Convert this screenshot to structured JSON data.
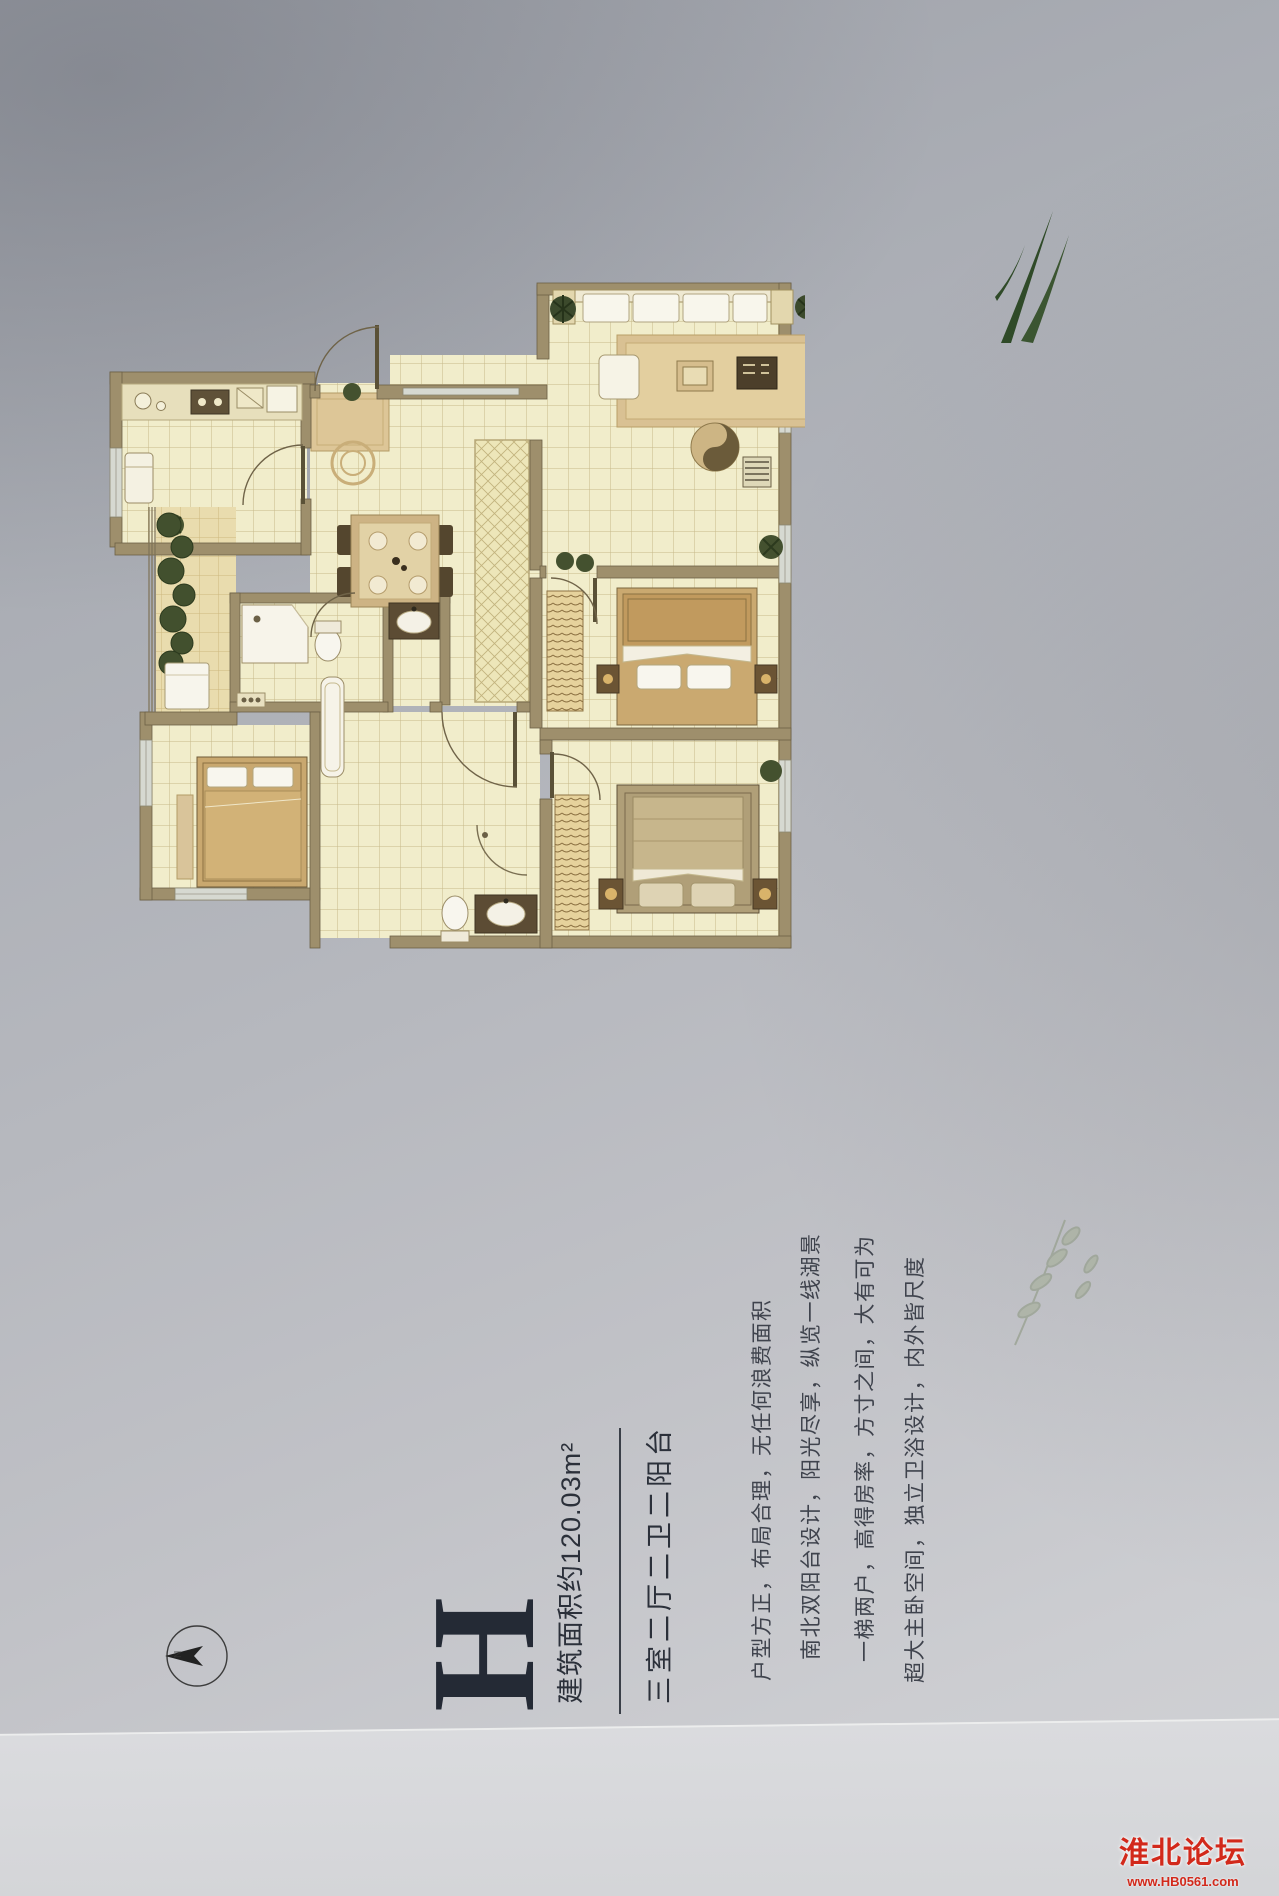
{
  "unit": {
    "letter": "H",
    "area_label": "建筑面积约120.03m²",
    "layout_label": "三室二厅二卫二阳台",
    "features": [
      "户型方正，布局合理，无任何浪费面积",
      "南北双阳台设计，阳光尽享，纵览一线湖景",
      "一梯两户，高得房率，方寸之间，大有可为",
      "超大主卧空间，独立卫浴设计，内外皆尺度"
    ]
  },
  "compass": {
    "north_label": "N"
  },
  "watermark": {
    "site_name": "淮北论坛",
    "site_url": "www.HB0561.com",
    "accent_color": "#d2291b"
  },
  "floorplan": {
    "wall_color": "#9e8f6c",
    "floor_color": "#f1edcb",
    "balcony_floor_color": "#e9dcae",
    "plant_color": "#42502e",
    "rooms": [
      "kitchen",
      "entry",
      "living-room",
      "dining-area",
      "hallway",
      "bathroom",
      "master-bathroom",
      "bedroom",
      "second-bedroom",
      "master-bedroom",
      "balcony",
      "laundry-balcony"
    ]
  }
}
